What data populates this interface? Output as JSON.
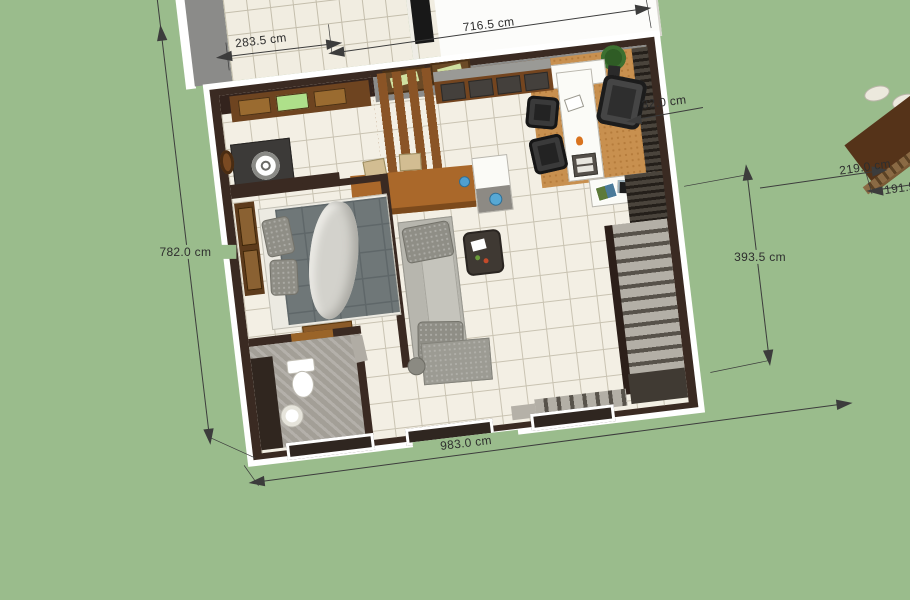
{
  "scene": {
    "description": "3D bird's-eye floor plan render on green ground",
    "background_color": "#9abc8c",
    "floor_tile_color": "#f3efe4",
    "wall_color": "#3a2a22",
    "carpet_color": "#c8904f",
    "dimension_text_color": "#2e2e2e"
  },
  "dimensions": {
    "porch_width": "283.5 cm",
    "top_width": "716.5 cm",
    "right_wall_offset": "32.0 cm",
    "left_height": "782.0 cm",
    "right_span": "393.5 cm",
    "bottom_width": "983.0 cm",
    "side_table_depth": "219.0 cm",
    "side_table_width_partial": "191.5"
  }
}
